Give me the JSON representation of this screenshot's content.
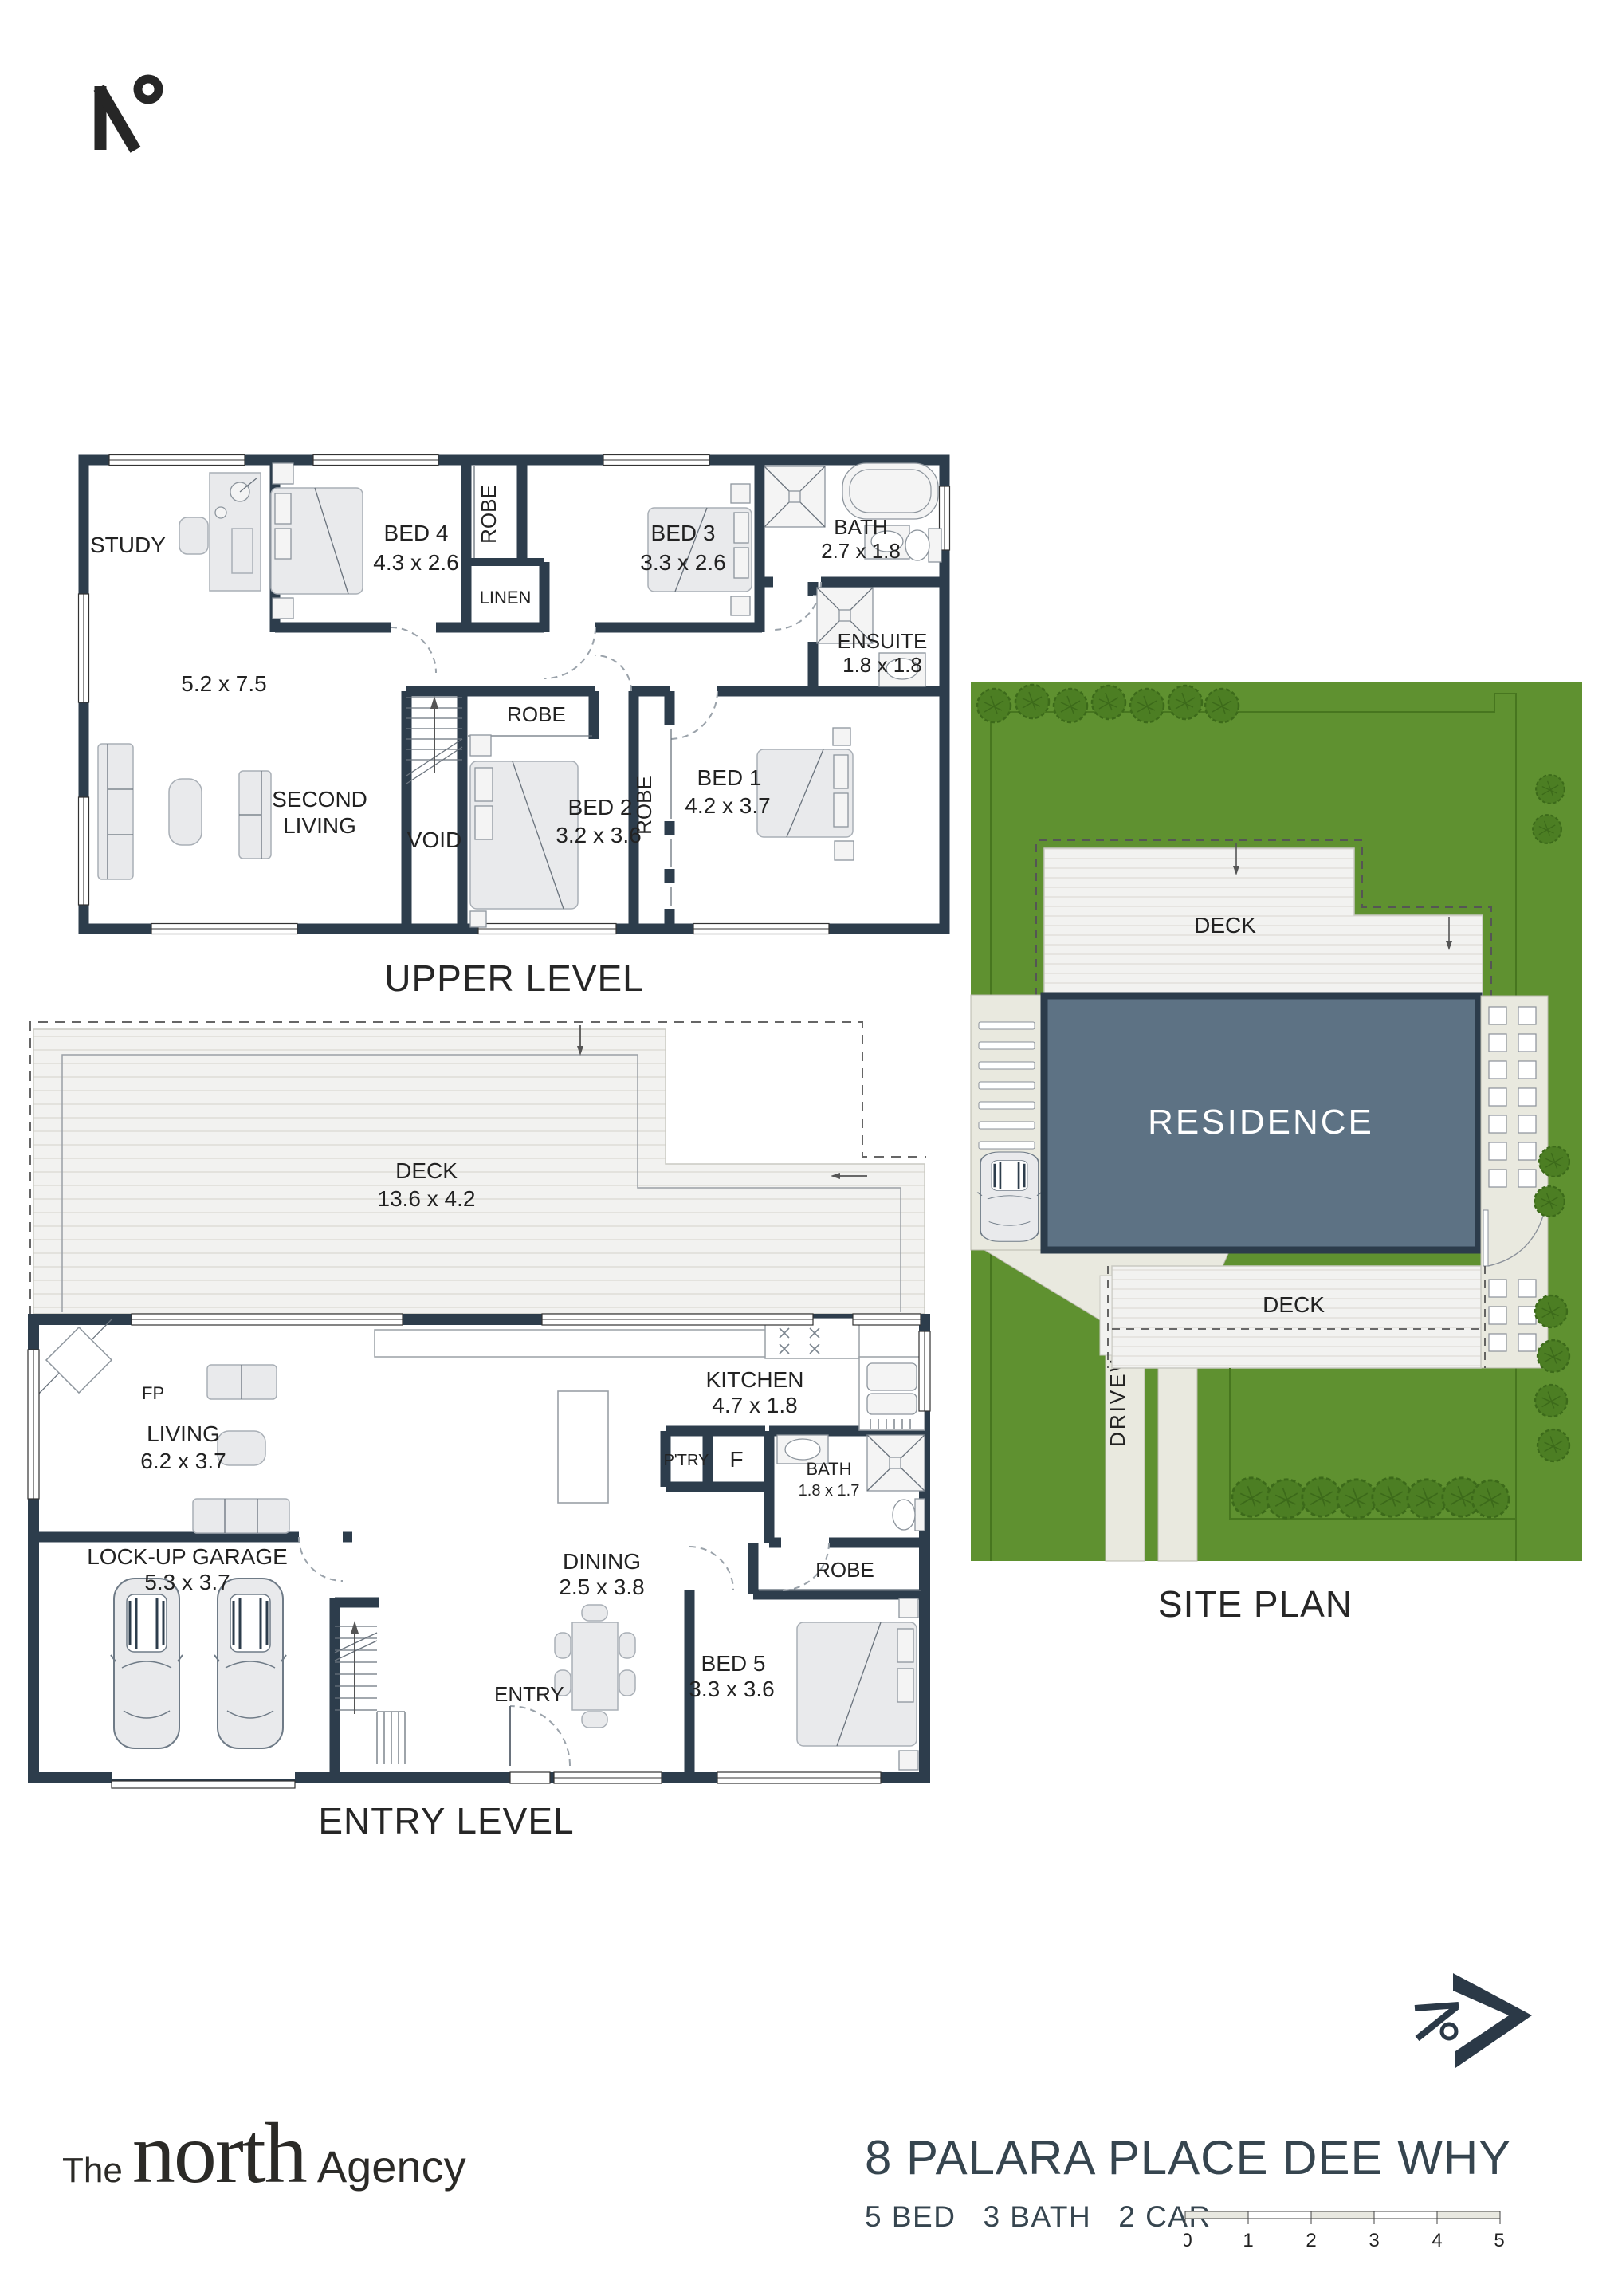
{
  "brand": {
    "the": "The",
    "north": "north",
    "agency": "Agency"
  },
  "upper": {
    "caption": "UPPER LEVEL",
    "study": "STUDY",
    "open_size": "5.2 x 7.5",
    "bed4": {
      "name": "BED 4",
      "size": "4.3 x 2.6"
    },
    "robe_bed4": "ROBE",
    "linen": "LINEN",
    "bed3": {
      "name": "BED 3",
      "size": "3.3 x 2.6"
    },
    "bath": {
      "name": "BATH",
      "size": "2.7 x 1.8"
    },
    "ensuite": {
      "name": "ENSUITE",
      "size": "1.8 x 1.8"
    },
    "second_living": {
      "line1": "SECOND",
      "line2": "LIVING"
    },
    "void": "VOID",
    "robe_bed2": "ROBE",
    "bed2": {
      "name": "BED 2",
      "size": "3.2 x 3.6"
    },
    "robe_bed1": "ROBE",
    "bed1": {
      "name": "BED 1",
      "size": "4.2 x 3.7"
    }
  },
  "entry": {
    "caption": "ENTRY LEVEL",
    "deck": {
      "name": "DECK",
      "size": "13.6 x 4.2"
    },
    "fp": "FP",
    "living": {
      "name": "LIVING",
      "size": "6.2 x 3.7"
    },
    "kitchen": {
      "name": "KITCHEN",
      "size": "4.7 x 1.8"
    },
    "pantry": "P'TRY",
    "fridge": "F",
    "bath": {
      "name": "BATH",
      "size": "1.8 x 1.7"
    },
    "garage": {
      "name": "LOCK-UP GARAGE",
      "size": "5.3 x 3.7"
    },
    "dining": {
      "name": "DINING",
      "size": "2.5 x 3.8"
    },
    "robe": "ROBE",
    "bed5": {
      "name": "BED 5",
      "size": "3.3 x 3.6"
    },
    "entry_label": "ENTRY"
  },
  "site": {
    "caption": "SITE PLAN",
    "residence": "RESIDENCE",
    "deck_top": "DECK",
    "deck_bottom": "DECK",
    "driveway": "DRIVEWAY"
  },
  "footer": {
    "address": "8 PALARA PLACE DEE WHY",
    "stats": [
      "5 BED",
      "3 BATH",
      "2 CAR"
    ],
    "scale_ticks": [
      "0",
      "1",
      "2",
      "3",
      "4",
      "5"
    ]
  },
  "colors": {
    "wall": "#2d3d4c",
    "lawn": "#5f9130",
    "residence": "#5d7284",
    "accent": "#2b3947"
  }
}
